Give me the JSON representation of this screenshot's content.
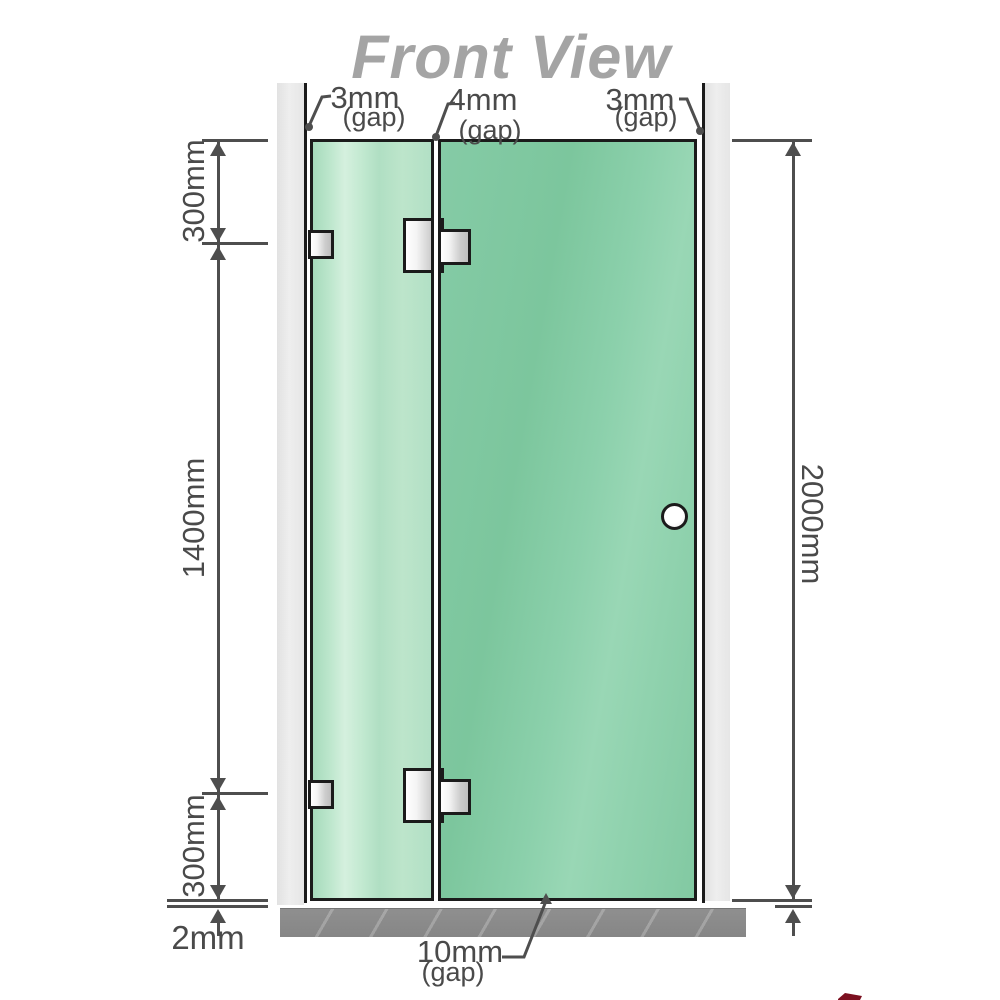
{
  "title": "Front View",
  "annotations": {
    "gap_top_left": {
      "value": "3mm",
      "note": "(gap)"
    },
    "gap_top_center": {
      "value": "4mm",
      "note": "(gap)"
    },
    "gap_top_right": {
      "value": "3mm",
      "note": "(gap)"
    },
    "gap_bottom": {
      "value": "10mm",
      "note": "(gap)"
    },
    "floor_gap": {
      "value": "2mm"
    }
  },
  "dimensions": {
    "left_top": "300mm",
    "left_middle": "1400mm",
    "left_bottom": "300mm",
    "right_full": "2000mm"
  },
  "colors": {
    "glass_fixed_panel": "#b7e3c8",
    "glass_door_panel": "#82c9a3",
    "wall": "#e9e9e9",
    "floor": "#8a8a8a",
    "dimension_lines": "#4e4e4e",
    "title_text": "#a4a4a4",
    "outline": "#1b1b1b",
    "watermark": "#7c1020"
  }
}
